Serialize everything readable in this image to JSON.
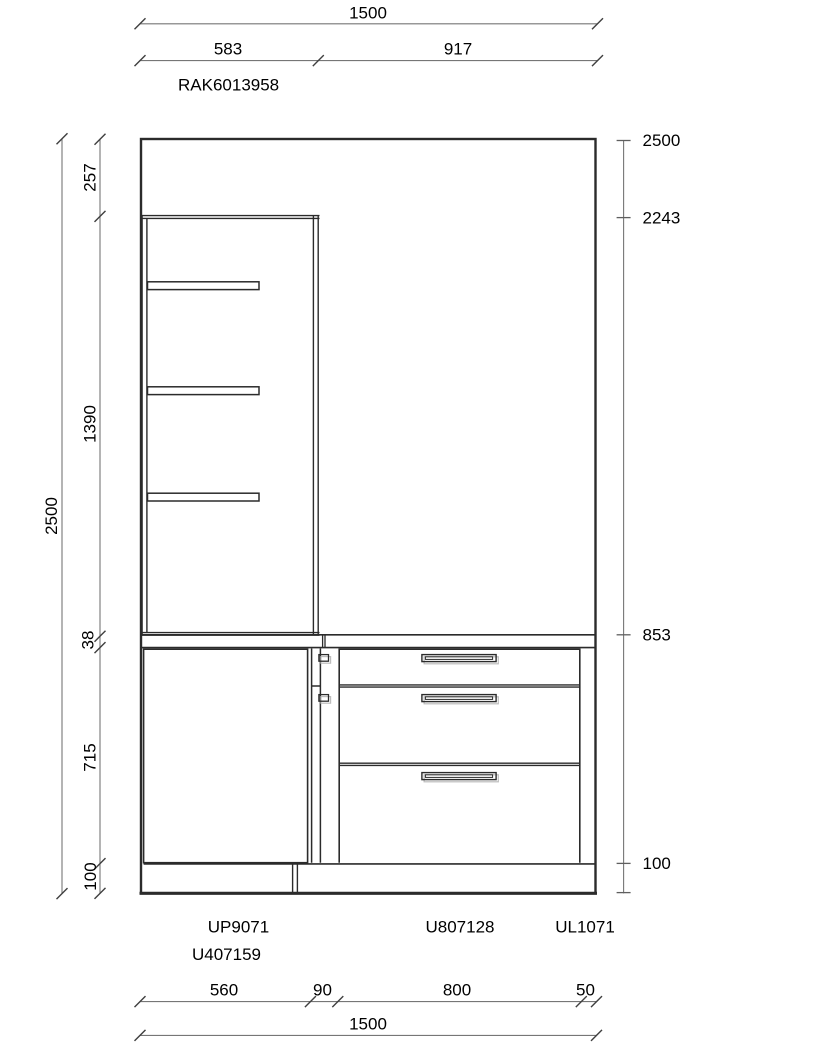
{
  "colors": {
    "object_line": "#2b2b2b",
    "dimension_line": "#767676",
    "text": "#000000",
    "background": "#ffffff"
  },
  "drawing": {
    "top": {
      "total": "1500",
      "seg_left": "583",
      "seg_right": "917",
      "product_code": "RAK6013958"
    },
    "left": {
      "overall": "2500",
      "segments": [
        "257",
        "1390",
        "38",
        "715",
        "100"
      ]
    },
    "right_elevation": {
      "marks": [
        "2500",
        "2243",
        "853",
        "100"
      ]
    },
    "bottom": {
      "unit_labels": [
        "UP9071",
        "U807128",
        "UL1071",
        "U407159"
      ],
      "segments": [
        "560",
        "90",
        "800",
        "50"
      ],
      "total": "1500"
    }
  }
}
